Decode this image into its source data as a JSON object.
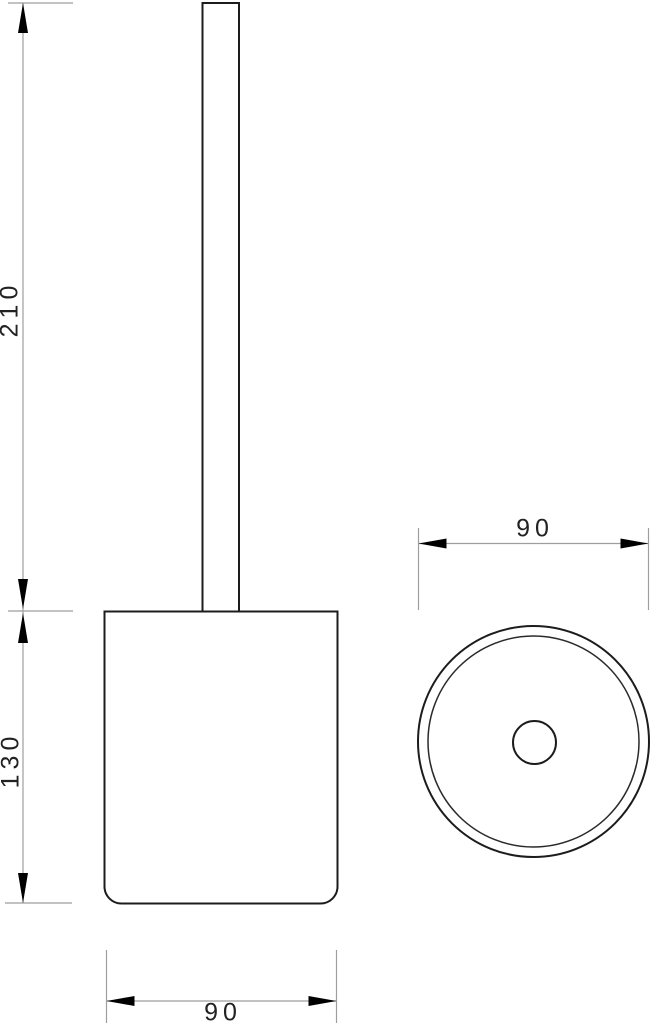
{
  "drawing": {
    "type": "technical-dimension-drawing",
    "views": {
      "side_view": {
        "handle_height_label": "210",
        "container_height_label": "130",
        "container_width_label": "90"
      },
      "top_view": {
        "diameter_label": "90"
      }
    },
    "colors": {
      "background": "#ffffff",
      "object_line": "#1c1c1c",
      "dimension_line": "#9e9e9e",
      "arrowhead": "#000000",
      "label_text": "#222222"
    }
  }
}
